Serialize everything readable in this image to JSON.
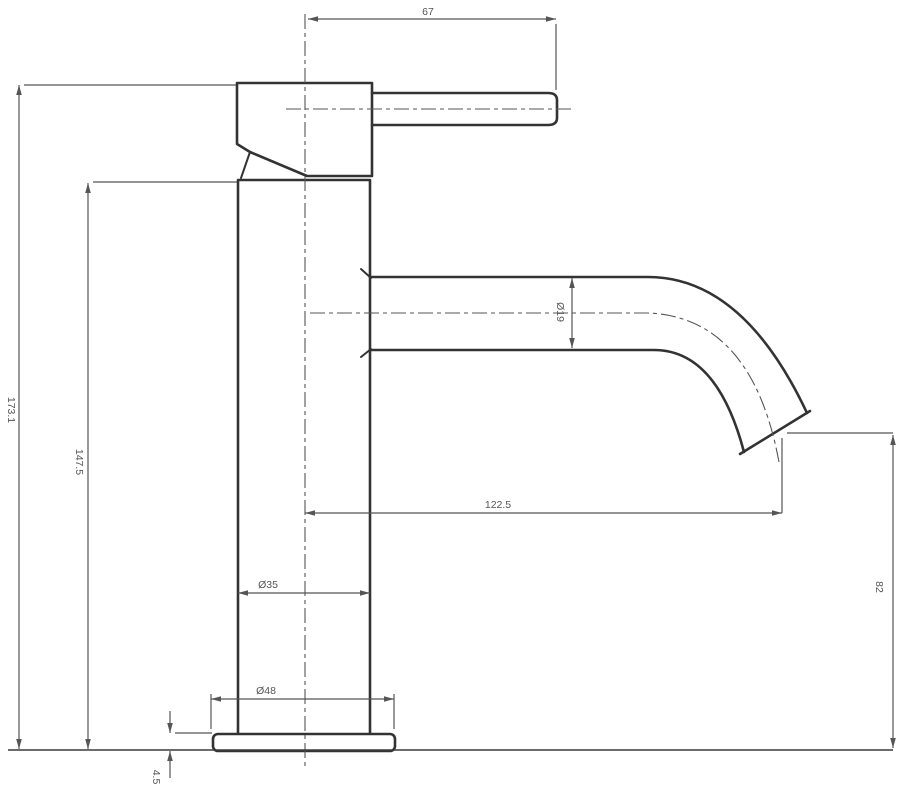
{
  "drawing": {
    "type": "technical-dimension-drawing",
    "subject": "single-lever basin mixer tap, side elevation",
    "units": "mm",
    "dimensions": {
      "lever_length": "67",
      "overall_height": "173.1",
      "height_to_body_top": "147.5",
      "spout_tube_diameter": "Ø19",
      "spout_reach_from_axis": "122.5",
      "spout_outlet_height": "82",
      "body_diameter": "Ø35",
      "base_diameter": "Ø48",
      "base_plate_thickness": "4.5"
    },
    "colors": {
      "outline": "#333333",
      "dimension": "#555555",
      "background": "#ffffff"
    }
  }
}
